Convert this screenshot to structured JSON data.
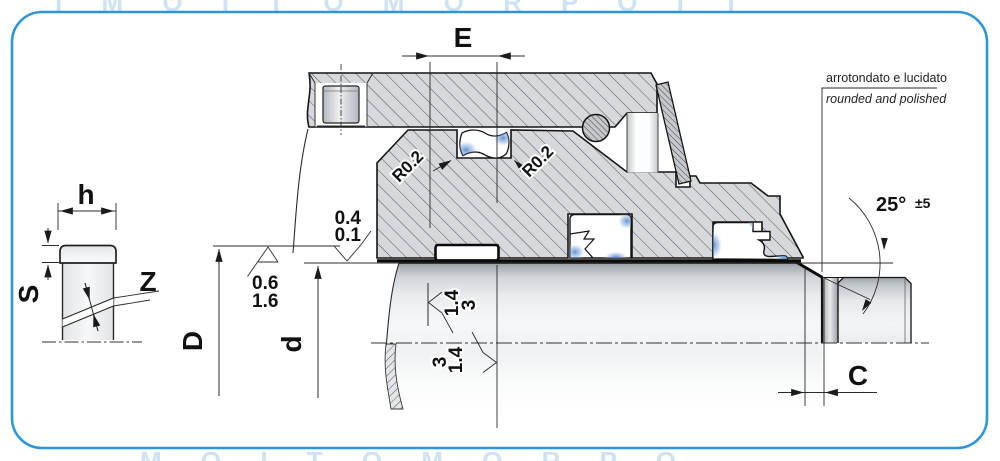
{
  "frame": {
    "border_color": "#2e96d8"
  },
  "watermark": {
    "top_row": "I M O I T O M O R P O I T",
    "bottom_row": "M O I T O M O R P O",
    "mark_a": "PRO",
    "mark_b": "N"
  },
  "left_view": {
    "h": "h",
    "s": "S",
    "z": "Z"
  },
  "dims": {
    "e": "E",
    "d_big": "D",
    "d_small": "d",
    "c": "C"
  },
  "angle": {
    "value": "25°",
    "tol": "±5"
  },
  "radius": {
    "left": "R0.2",
    "right": "R0.2"
  },
  "finish": {
    "upper": {
      "l1": "0.4",
      "l2": "0.1"
    },
    "lower": {
      "l1": "0.6",
      "l2": "1.6"
    },
    "rod_upper": {
      "l1": "1.4",
      "l2": "3"
    },
    "rod_lower": {
      "l1": "3",
      "l2": "1.4"
    }
  },
  "note": {
    "it": "arrotondato e lucidato",
    "en": "rounded and polished"
  },
  "colors": {
    "border": "#2e96d8",
    "metal_fill": "#d6d8db",
    "hatch_line": "#52555a",
    "seal_blue": "#5b8fd4",
    "outline": "#141414"
  }
}
